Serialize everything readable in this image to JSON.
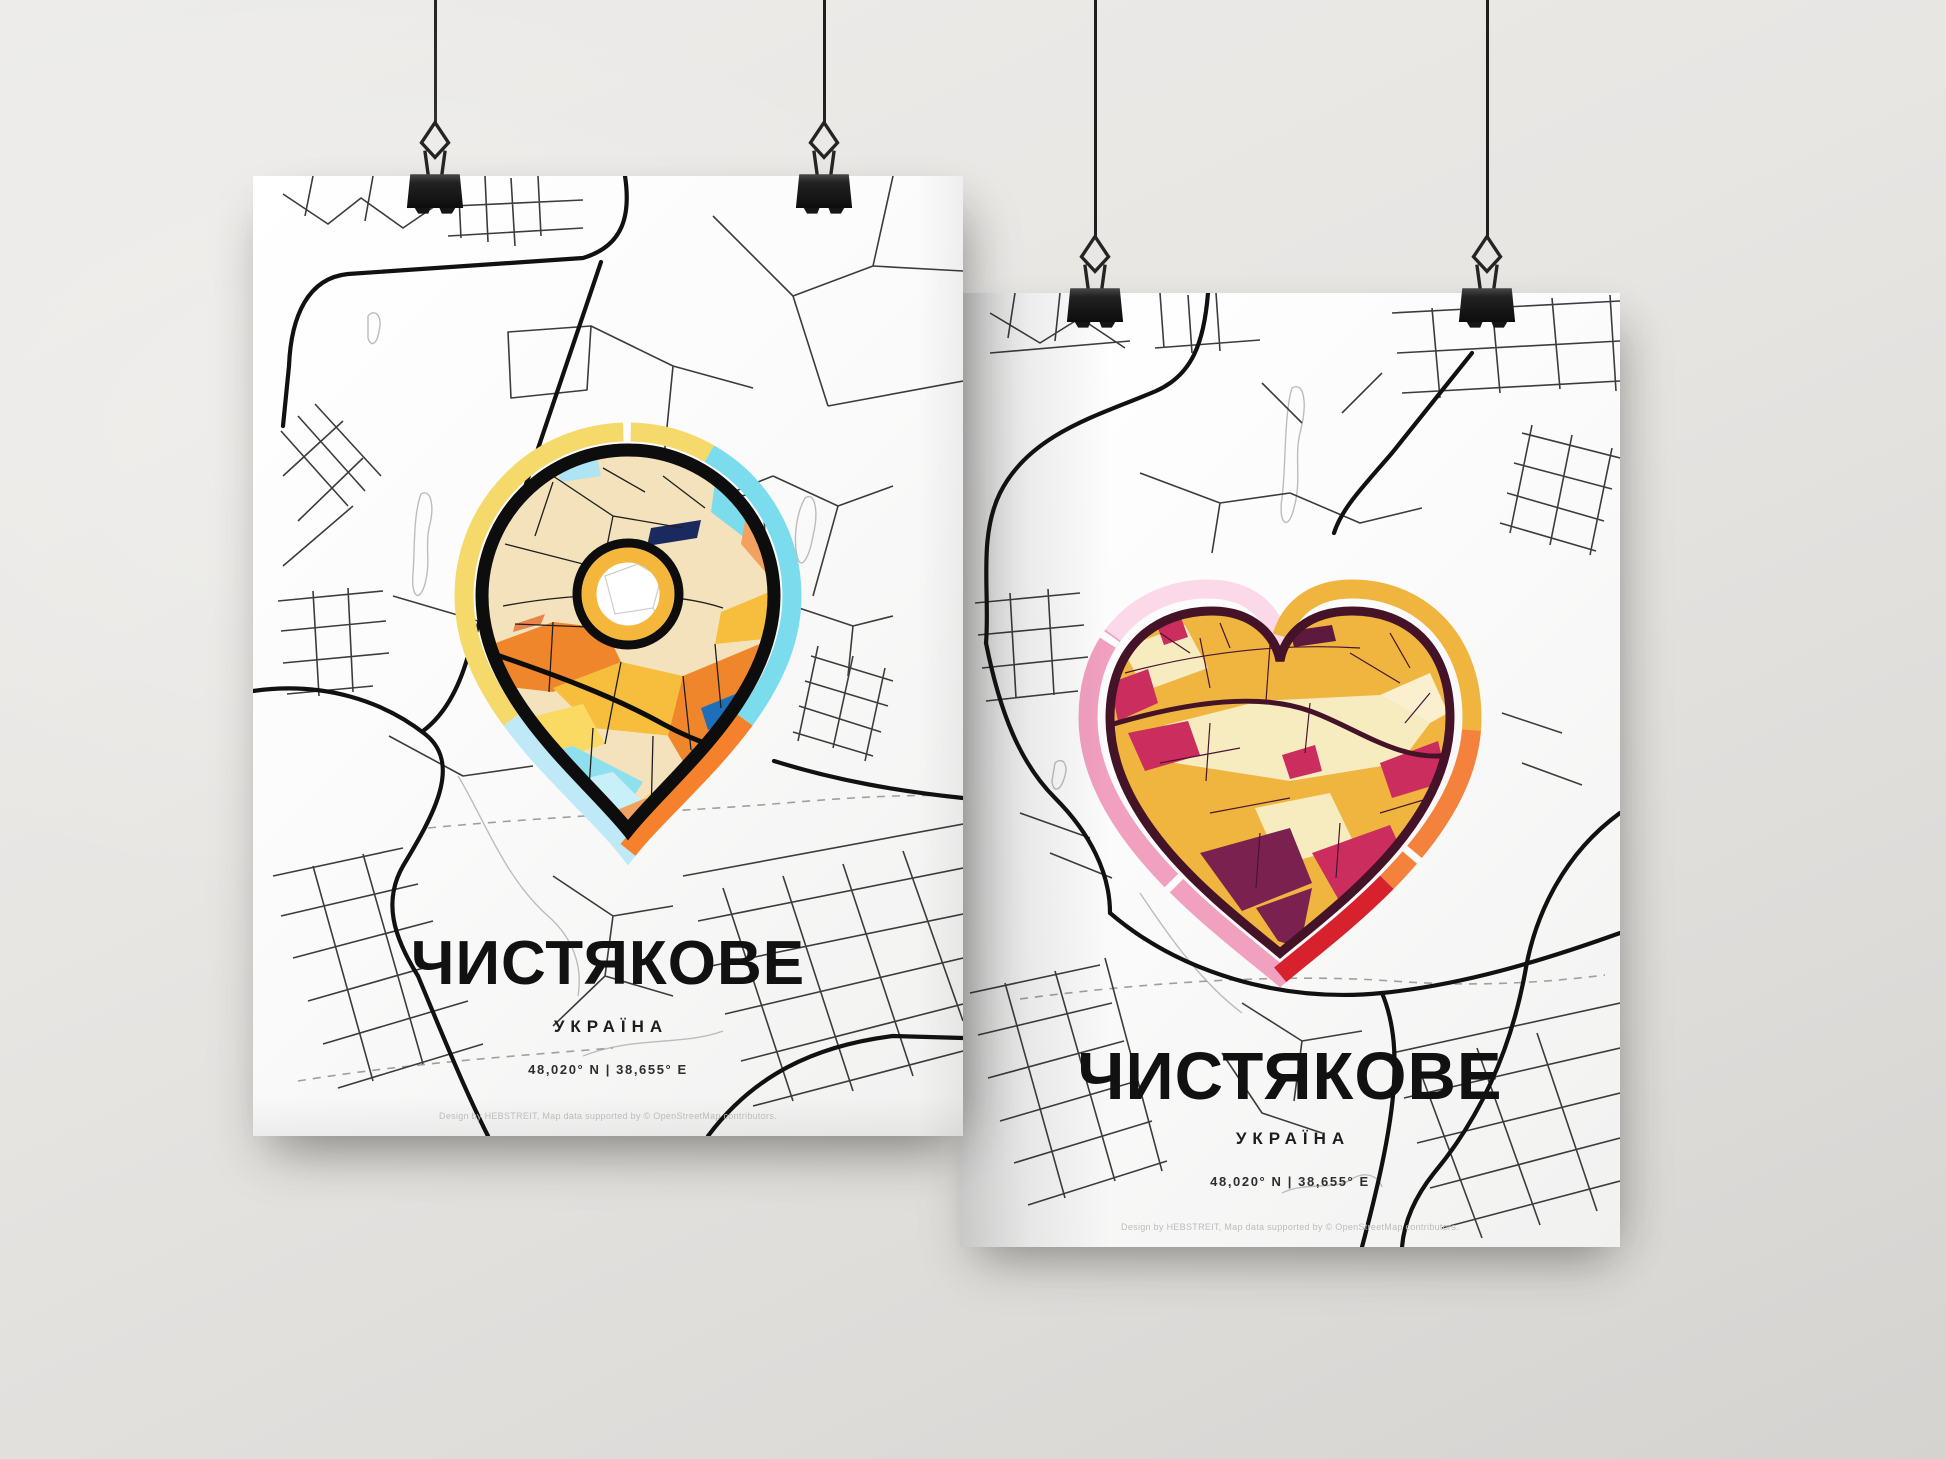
{
  "wall": {
    "color_top": "#edecea",
    "color_bottom": "#d5d3d0"
  },
  "hardware": {
    "string_color": "#1f1f1f",
    "clip_color": "#1c1c1c",
    "clip_style": "black binder clip with wire handle"
  },
  "posters": [
    {
      "variant": "map-pin",
      "marker_icon": "map-pin-icon",
      "title": "ЧИСТЯКОВЕ",
      "subtitle": "УКРАЇНА",
      "coordinates": "48,020° N | 38,655° E",
      "credit": "Design by HEBSTREIT, Map data supported by © OpenStreetMap contributors.",
      "marker_palette": {
        "rim_yellow": "#F6D96B",
        "rim_cyan": "#7ADCEC",
        "rim_orange": "#F5812C",
        "rim_pale_blue": "#BFE9F6",
        "beige": "#F3E2BC",
        "orange": "#F0862B",
        "amber": "#F6BE3C",
        "yellow": "#FBDA63",
        "salmon": "#F2A160",
        "cyan": "#8FE0EE",
        "blue": "#2173BE",
        "navy": "#1A2A5E",
        "outline": "#0d0d0d"
      }
    },
    {
      "variant": "heart",
      "marker_icon": "heart-icon",
      "title": "ЧИСТЯКОВЕ",
      "subtitle": "УКРАЇНА",
      "coordinates": "48,020° N | 38,655° E",
      "credit": "Design by HEBSTREIT, Map data supported by © OpenStreetMap contributors.",
      "marker_palette": {
        "rim_pink": "#F2A0C0",
        "rim_light_pink": "#FBD9E8",
        "rim_gold": "#EFB53F",
        "rim_orange": "#F5823C",
        "rim_red": "#D7222E",
        "gold": "#EFB53F",
        "cream": "#F7EBC0",
        "magenta": "#CB2D5F",
        "purple": "#7A2150",
        "maroon": "#5E1A3E",
        "outline": "#451327"
      }
    }
  ]
}
